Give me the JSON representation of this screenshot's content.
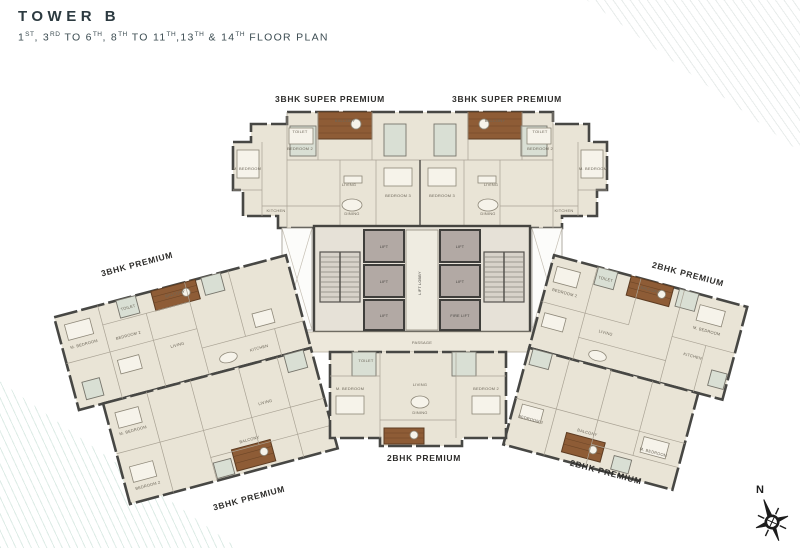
{
  "header": {
    "title": "TOWER B",
    "subtitle_segments": [
      {
        "t": "1",
        "s": "ST"
      },
      {
        "t": ", 3",
        "s": "RD"
      },
      {
        "t": " TO 6",
        "s": "TH"
      },
      {
        "t": ", 8",
        "s": "TH"
      },
      {
        "t": " TO 11",
        "s": "TH"
      },
      {
        "t": ",13",
        "s": "TH"
      },
      {
        "t": " & 14",
        "s": "TH"
      },
      {
        "t": " FLOOR PLAN",
        "s": ""
      }
    ]
  },
  "floor_plan": {
    "unit_labels": [
      {
        "label": "3BHK SUPER PREMIUM"
      },
      {
        "label": "3BHK SUPER PREMIUM"
      },
      {
        "label": "3BHK PREMIUM"
      },
      {
        "label": "2BHK PREMIUM"
      },
      {
        "label": "3BHK PREMIUM"
      },
      {
        "label": "2BHK PREMIUM"
      },
      {
        "label": "2BHK PREMIUM"
      }
    ],
    "room_names": {
      "master": "M. BEDROOM",
      "bed2": "BEDROOM 2",
      "bed3": "BEDROOM 3",
      "living": "LIVING",
      "dining": "DINING",
      "kitchen": "KITCHEN",
      "toilet": "TOILET",
      "balcony": "BALCONY"
    },
    "core": {
      "lift": "LIFT",
      "fire_lift": "FIRE LIFT",
      "lobby": "LIFT LOBBY",
      "passage": "PASSAGE"
    },
    "compass": {
      "north": "N"
    },
    "colors": {
      "wall": "#474744",
      "room_fill": "#e9e4d6",
      "toilet_fill": "#d9dfd4",
      "balcony_fill": "#8e5c36",
      "lift_fill": "#b2a9a4",
      "corridor_fill": "#ede8db",
      "title_text": "#2c3a40",
      "label_text": "#2e2d2b"
    }
  }
}
